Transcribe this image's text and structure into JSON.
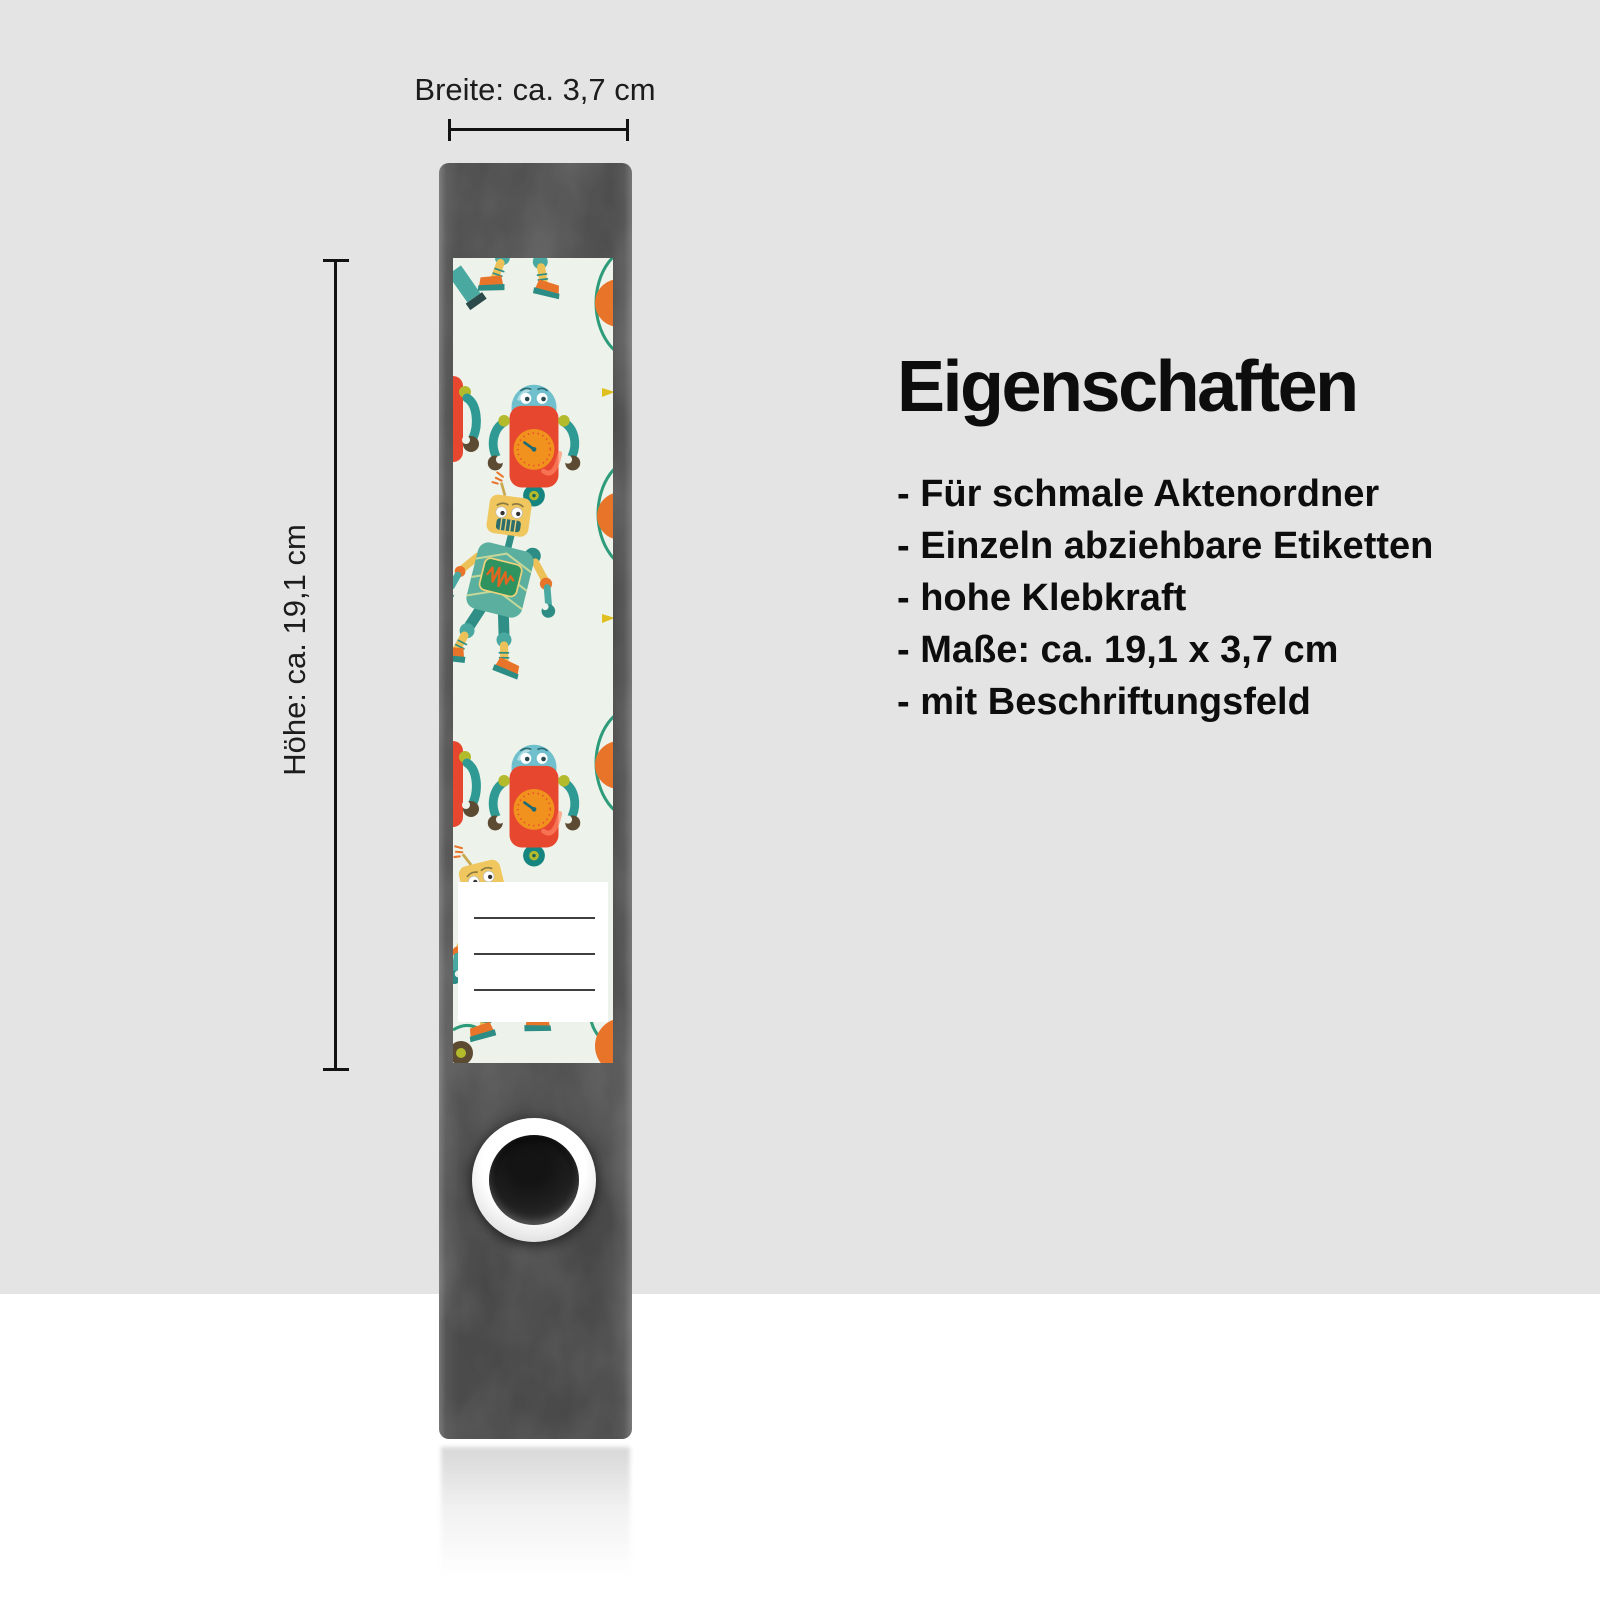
{
  "annotations": {
    "width_text": "Breite: ca. 3,7 cm",
    "height_text": "Höhe: ca. 19,1 cm"
  },
  "properties": {
    "title": "Eigenschaften",
    "items": [
      "- Für schmale Aktenordner",
      "- Einzeln abziehbare Etiketten",
      "- hohe Klebkraft",
      "- Maße: ca. 19,1 x 3,7 cm",
      "- mit Beschriftungsfeld"
    ]
  },
  "label": {
    "writing_field_lines": 3,
    "pattern": "robots"
  },
  "colors": {
    "background_top": "#e4e4e4",
    "background_bottom": "#ffffff",
    "binder_spine": "#4b4b4b",
    "label_background": "#edf3ea",
    "robot_red": "#e8472f",
    "robot_clock_orange": "#f1921e",
    "robot_teal": "#2f9a93",
    "robot_dome_teal": "#6fc0cc",
    "robot_yellow": "#f0c75e",
    "robot_body_teal": "#5aaf9f",
    "shoe_orange": "#e8742a",
    "accent_lime": "#b3ba2b",
    "claw_brown": "#5d4a33",
    "annotation_text": "#1c1c1c"
  }
}
